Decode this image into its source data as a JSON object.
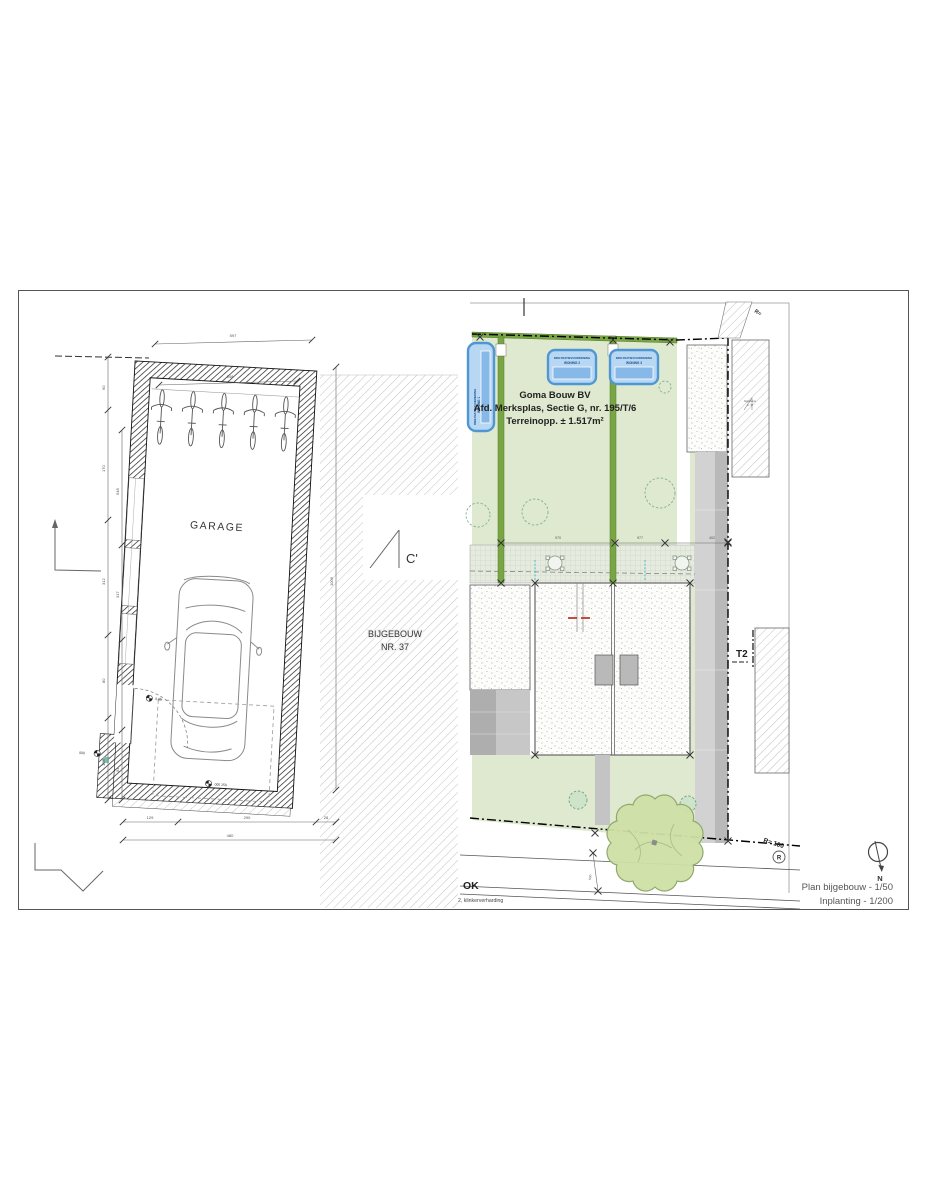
{
  "page": {
    "background": "#ffffff",
    "border_color": "#555555"
  },
  "left_plan": {
    "name": "Plan bijgebouw",
    "room_label": "GARAGE",
    "neighbor_line1": "BIJGEBOUW",
    "neighbor_line2": "NR. 37",
    "section_marker": "C'",
    "dims": {
      "top": "597",
      "top_inner": "548",
      "right_total": "1006",
      "left_outer": [
        "90",
        "170",
        "312",
        "80",
        "128"
      ],
      "left_inner": [
        "548",
        "317",
        "94"
      ],
      "bottom_segments": [
        "129",
        "290",
        "28"
      ],
      "bottom_total": "480",
      "level_door": "0.05",
      "level_floor": "005 250",
      "level_out": "090"
    }
  },
  "site_plan": {
    "name": "Inplanting",
    "company": "Goma Bouw BV",
    "address": "Afd. Merksplas, Sectie G, nr. 195/T/6",
    "area": "Terreinopp. ± 1.517m²",
    "basin1_line1": "INFILTRATIEVOORZIENING",
    "basin1_line2": "WONING 1",
    "basin2_line1": "INFILTRATIEVOORZIENING",
    "basin2_line2": "WONING 2",
    "basin3_line1": "INFILTRATIEVOORZIENING",
    "basin3_line2": "WONING 3",
    "neighbor_label_line1": "bijgebouw",
    "neighbor_label_line2": "nr. 37",
    "t2_label": "T2",
    "r_edge_label": "R=",
    "r_label": "R= 100",
    "r_circle": "R",
    "ok_label": "OK",
    "paving_note": "2, klinkerverharding",
    "dims": {
      "plot_left": "970",
      "plot_right": "977",
      "side": "402",
      "road": "500"
    }
  },
  "footer": {
    "north_letter": "N",
    "title_line1": "Plan bijgebouw - 1/50",
    "title_line2": "Inplanting - 1/200"
  },
  "colors": {
    "garden_green": "#dfe9d0",
    "hedge_green": "#7aa544",
    "basin_blue": "#4f97d4",
    "basin_fill": "#b7d7f3",
    "tree_fill": "#cddfa5",
    "paving_gray": "#c7c7c7"
  }
}
